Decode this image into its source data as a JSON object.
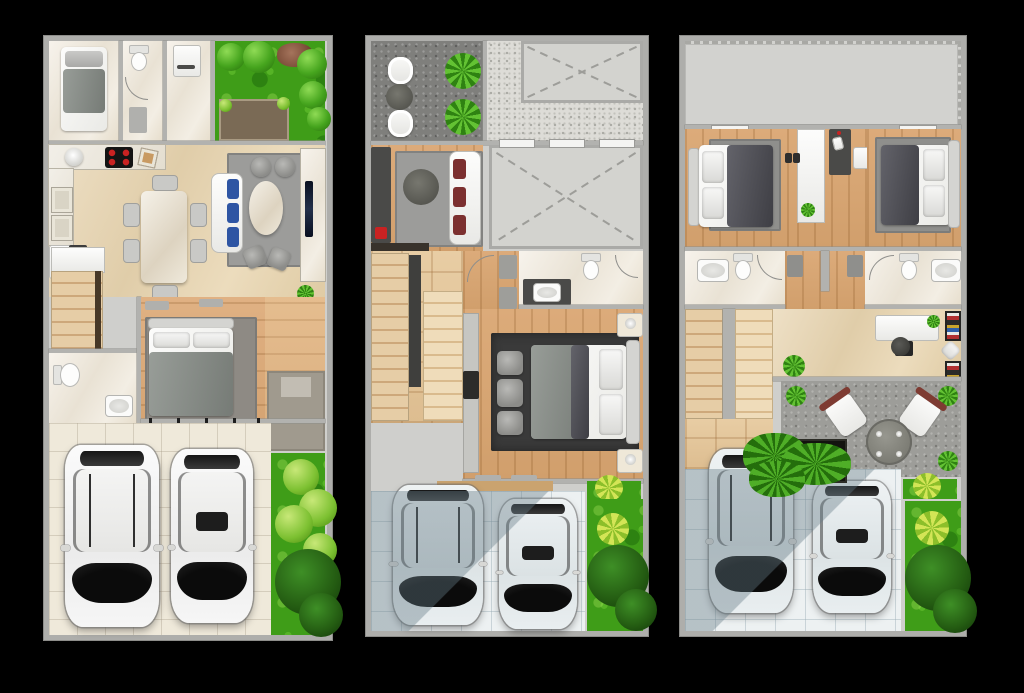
{
  "image": {
    "kind": "architectural-floor-plan-set",
    "width": 1024,
    "height": 693,
    "background": "#000000",
    "visible_text": "",
    "plan_count": 3
  },
  "palette": {
    "wall": "#aeaeab",
    "marble_white": "#f3eee4",
    "marble_beige": "#e8dabb",
    "wood": "#d9a873",
    "rug_gray": "#9c9c9a",
    "rug_dark": "#3a3a3a",
    "grass": "#3f9d18",
    "driveway_cream": "#efe9da",
    "driveway_blue": "#edf1f2",
    "granite": "#7f7f7c",
    "terrace": "#9d9d99",
    "accent_red": "#c92222",
    "cushion_blue": "#2e55a3",
    "cushion_maroon": "#7c3030",
    "car_body": "#f4f4f4",
    "car_glass": "#141414"
  },
  "plans": [
    {
      "name": "plan-a-ground-floor",
      "rooms": [
        "bedroom",
        "bathroom",
        "laundry",
        "garden-with-patio",
        "kitchen",
        "dining-area",
        "living-area",
        "staircase",
        "bathroom-2",
        "master-bedroom",
        "entry-porch",
        "driveway",
        "side-garden"
      ],
      "furniture": [
        "single-bed",
        "toilet",
        "washer",
        "l-shaped-kitchen-counter",
        "round-sink",
        "stove-4-burners",
        "cutting-board",
        "refrigerator",
        "dining-table-with-6-chairs",
        "sofa-with-blue-cushions",
        "two-pouffes",
        "oval-coffee-table",
        "two-floor-cushions",
        "wall-tv",
        "double-bed",
        "vanity-sink",
        "entry-mat",
        "potted-plant"
      ],
      "vehicles": [
        "white-suv",
        "white-sedan"
      ],
      "landscape": [
        "lawn",
        "shrubs",
        "rock-cluster",
        "brown-patio",
        "dark-tree"
      ]
    },
    {
      "name": "plan-b-middle-floor",
      "rooms": [
        "balcony",
        "stippled-roof-deck",
        "void-open-to-below-upper",
        "void-open-to-below-main",
        "family-room",
        "staircase",
        "bathroom",
        "master-bedroom",
        "wardrobe",
        "driveway",
        "side-garden"
      ],
      "furniture": [
        "two-balcony-chairs",
        "round-balcony-table",
        "two-planters",
        "tv-console-with-red-box",
        "round-table",
        "sofa-with-maroon-cushions",
        "dark-vanity-with-sink",
        "toilet",
        "double-bed",
        "three-ottomans",
        "two-nightstands-with-lamps",
        "bath-mats"
      ],
      "vehicles": [
        "suv-in-shade",
        "sedan-half-shade"
      ],
      "landscape": [
        "lawn-strip",
        "star-plant",
        "dark-tree"
      ]
    },
    {
      "name": "plan-c-top-floor",
      "rooms": [
        "flat-roof",
        "bedroom-left",
        "bedroom-right",
        "bathroom-left",
        "bathroom-right",
        "hallway",
        "study",
        "staircase",
        "roof-terrace",
        "driveway",
        "side-garden"
      ],
      "furniture": [
        "double-bed-left",
        "double-bed-right",
        "white-shelf-unit",
        "dark-work-desk",
        "desk-chair",
        "two-toilets",
        "two-sinks",
        "white-study-desk",
        "office-chair",
        "colorful-bookshelf",
        "two-terrace-chairs",
        "round-terrace-table",
        "planter-box-with-ferns",
        "corner-plants"
      ],
      "vehicles": [
        "suv-in-shade",
        "sedan-half-shade"
      ],
      "landscape": [
        "lawn-strip",
        "star-plant",
        "dark-tree"
      ]
    }
  ]
}
